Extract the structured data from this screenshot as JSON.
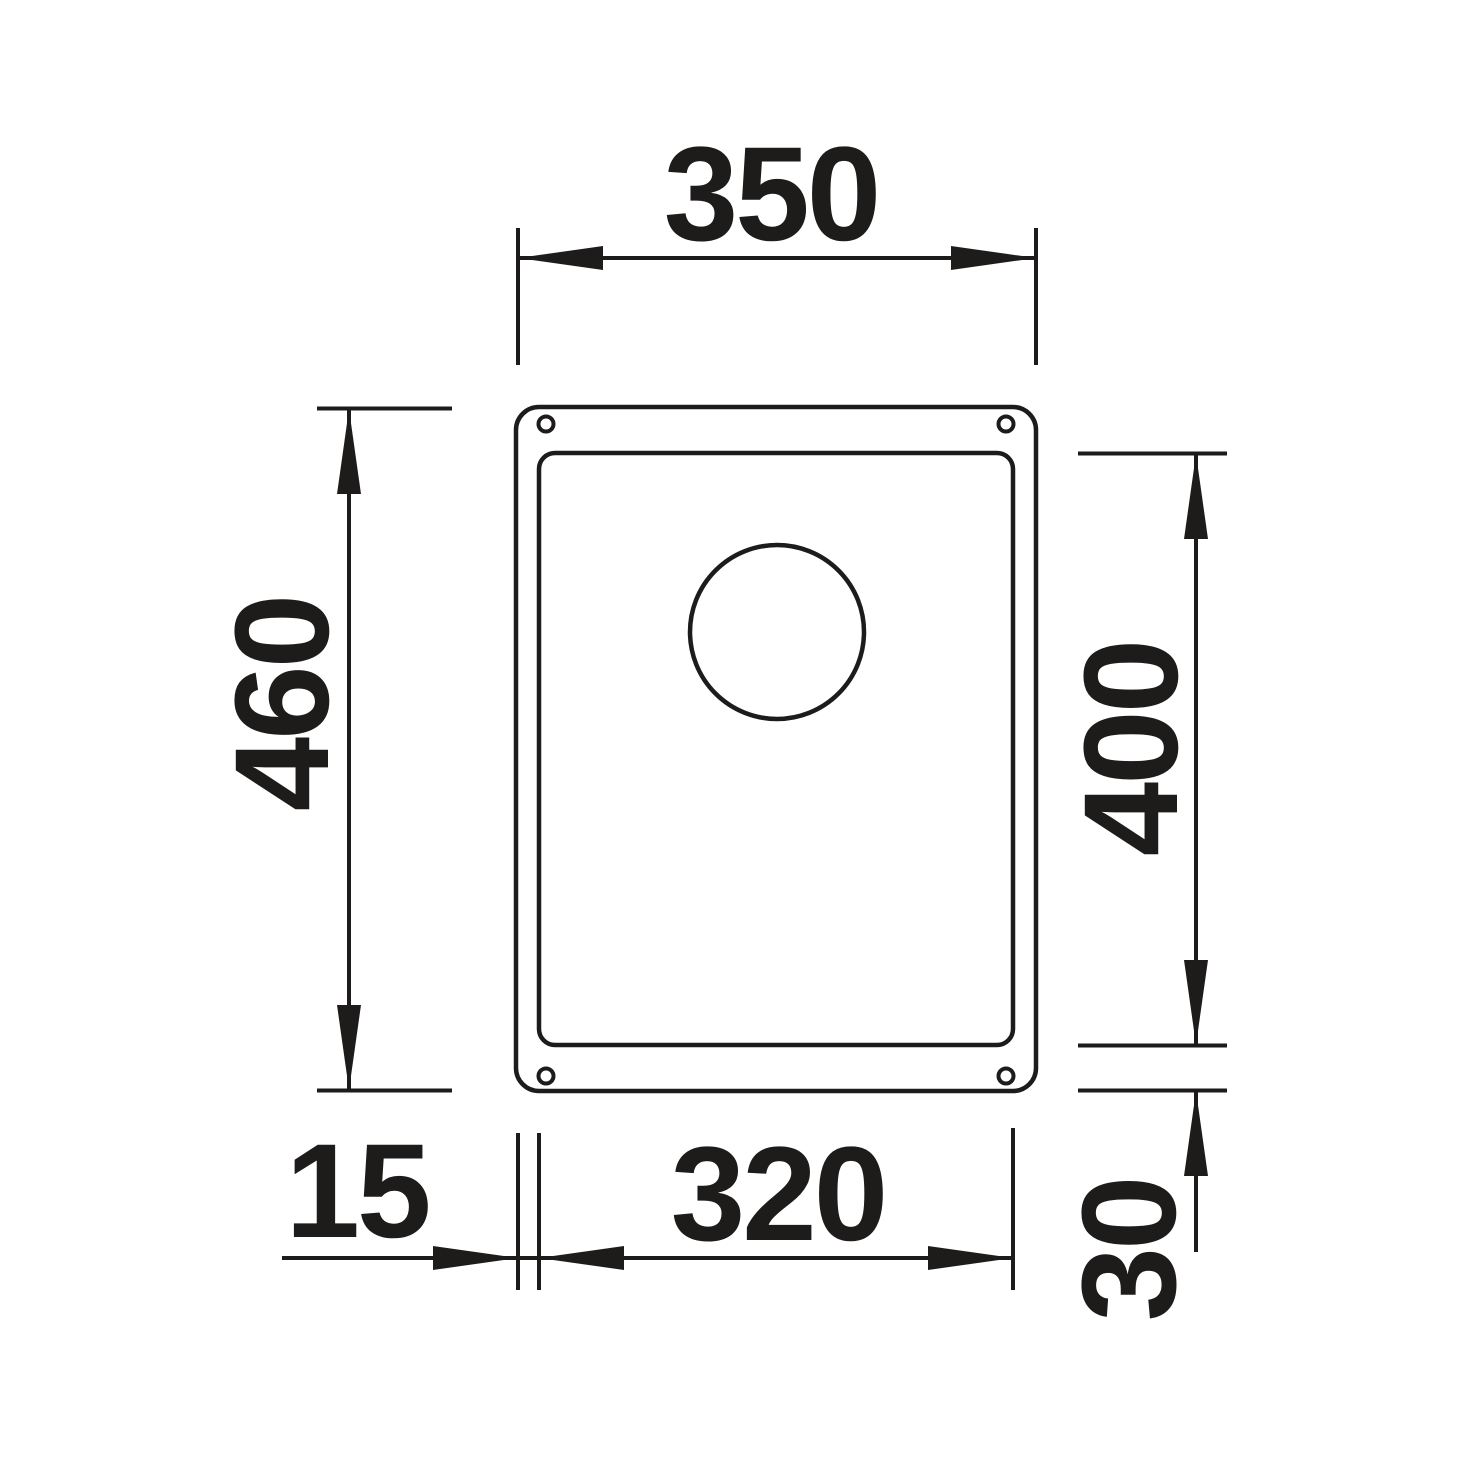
{
  "drawing": {
    "background_color": "#ffffff",
    "line_color": "#1e1b1b",
    "labels": {
      "overall_width": "350",
      "overall_height": "460",
      "inner_height": "400",
      "inner_width": "320",
      "left_inset": "15",
      "bottom_inset": "30"
    }
  }
}
